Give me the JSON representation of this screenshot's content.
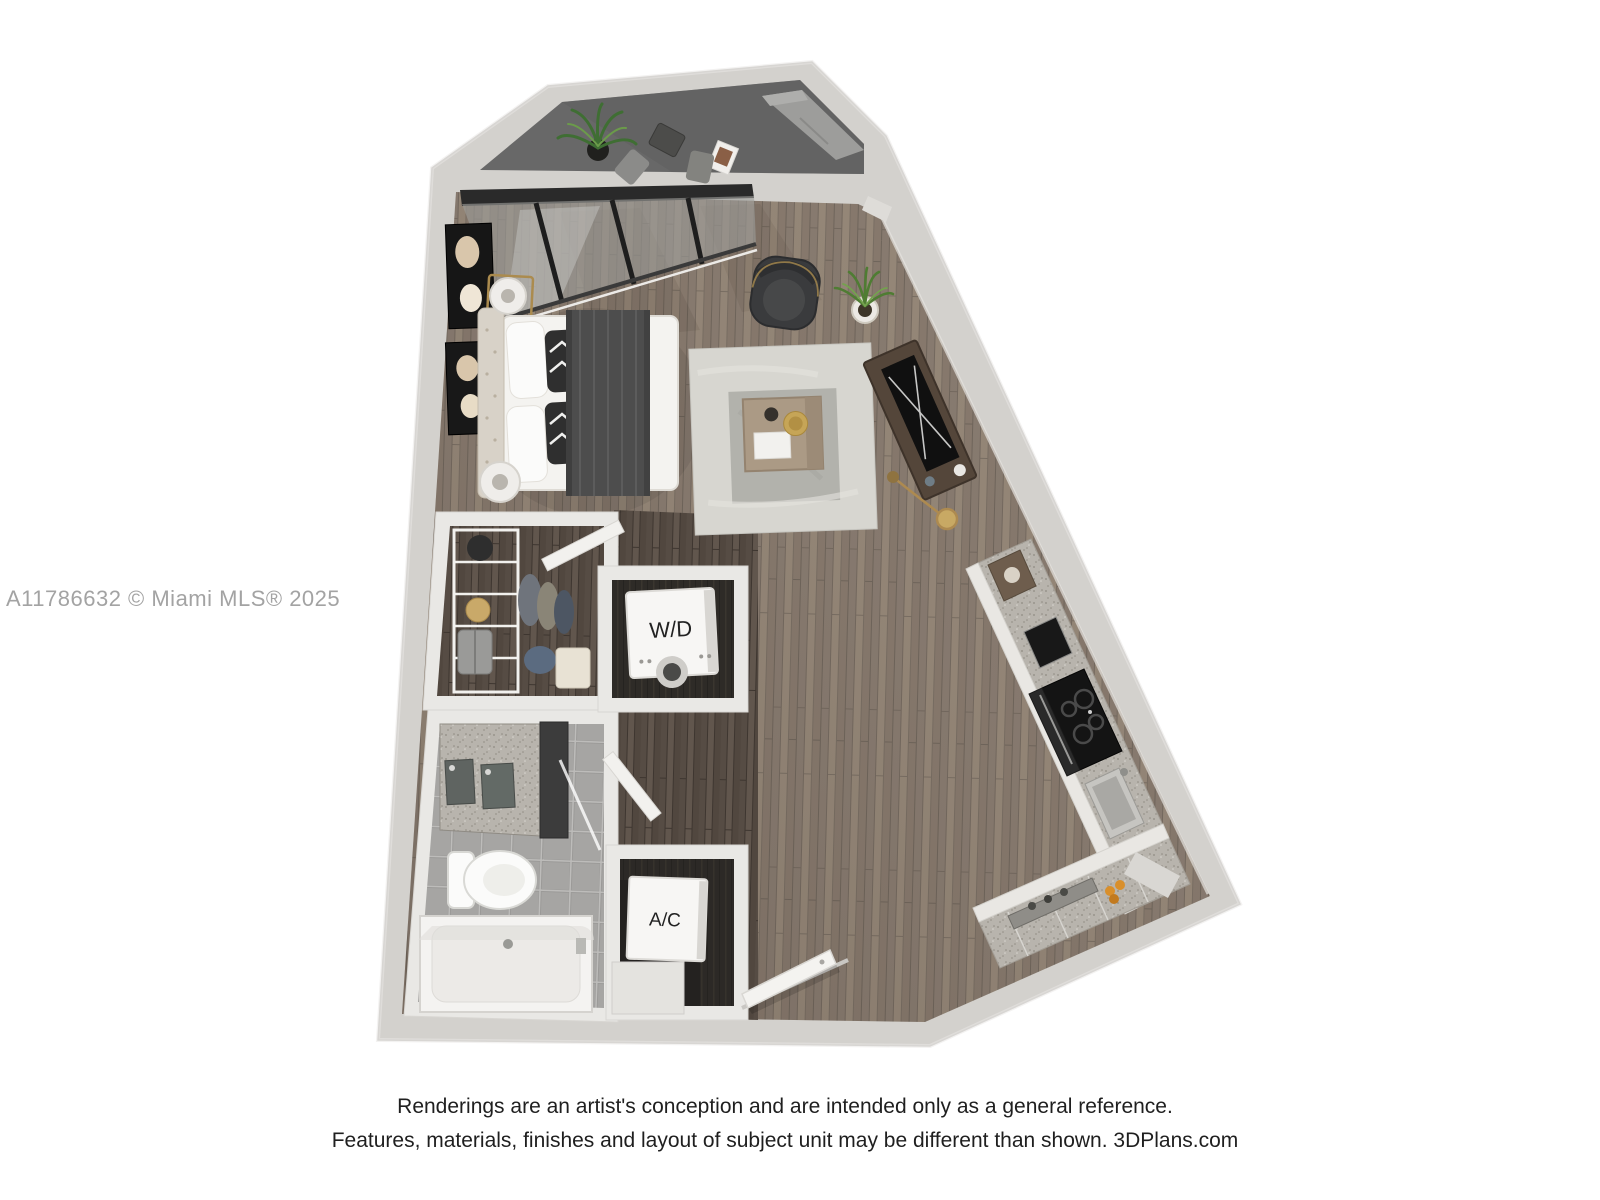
{
  "watermark": {
    "text": "A11786632 © Miami MLS® 2025"
  },
  "disclaimer": {
    "line1": "Renderings are an artist's conception and are intended only as a general reference.",
    "line2": "Features, materials, finishes and layout of subject unit may be different than shown. 3DPlans.com"
  },
  "plan": {
    "labels": {
      "wd": "W/D",
      "ac": "A/C"
    },
    "colors": {
      "background": "#ffffff",
      "outer_wall": "#d3d1cd",
      "inner_wall_highlight": "#e9e8e5",
      "balcony_floor": "#686868",
      "wood_floor": "#8e8177",
      "hallway_floor": "#5c524a",
      "bathroom_tile": "#a6a5a3",
      "counter_speckle": "#b8b4ad",
      "cabinet_face": "#e9e7e3",
      "appliance_black": "#161616",
      "rug_outer": "#d7d6d0",
      "rug_inner": "#b2b2ac",
      "bed_linen": "#f4f3f0",
      "blanket_gray": "#4d4d4d",
      "accent_chair": "#3a3b3d",
      "plant_green": "#4f7c33",
      "gold_accent": "#ad8a50",
      "watermark_text": "#a3a3a3",
      "disclaimer_text": "#1f1f1f"
    }
  }
}
